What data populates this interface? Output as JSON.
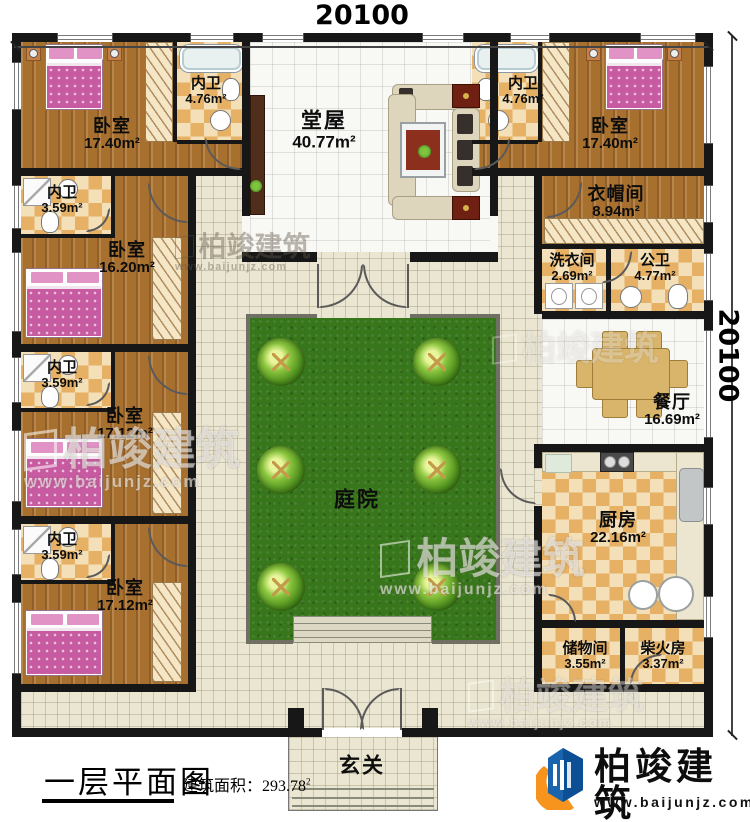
{
  "dimensions": {
    "top": "20100",
    "right": "20100"
  },
  "title_block": {
    "title": "一层平面图",
    "area_label": "建筑面积：",
    "area_value": "293.78",
    "area_sup": "2"
  },
  "brand": {
    "name": "柏竣建筑",
    "url": "www.baijunjz.com"
  },
  "watermark": {
    "name": "柏竣建筑",
    "url": "www.baijunjz.com"
  },
  "rooms": {
    "bedroom_nw": {
      "name": "卧室",
      "area": "17.40m²"
    },
    "ensuite_nw": {
      "name": "内卫",
      "area": "4.76m²"
    },
    "hall": {
      "name": "堂屋",
      "area": "40.77m²"
    },
    "ensuite_ne": {
      "name": "内卫",
      "area": "4.76m²"
    },
    "bedroom_ne": {
      "name": "卧室",
      "area": "17.40m²"
    },
    "bath_w1": {
      "name": "内卫",
      "area": "3.59m²"
    },
    "bedroom_w2": {
      "name": "卧室",
      "area": "16.20m²"
    },
    "cloakroom": {
      "name": "衣帽间",
      "area": "8.94m²"
    },
    "laundry": {
      "name": "洗衣间",
      "area": "2.69m²"
    },
    "public_bath": {
      "name": "公卫",
      "area": "4.77m²"
    },
    "bath_w2": {
      "name": "内卫",
      "area": "3.59m²"
    },
    "bedroom_w3": {
      "name": "卧室",
      "area": "17.12m²"
    },
    "dining": {
      "name": "餐厅",
      "area": "16.69m²"
    },
    "courtyard": {
      "name": "庭院"
    },
    "bath_w3": {
      "name": "内卫",
      "area": "3.59m²"
    },
    "bedroom_w4": {
      "name": "卧室",
      "area": "17.12m²"
    },
    "kitchen": {
      "name": "厨房",
      "area": "22.16m²"
    },
    "storage": {
      "name": "储物间",
      "area": "3.55m²"
    },
    "firewood": {
      "name": "柴火房",
      "area": "3.37m²"
    },
    "foyer": {
      "name": "玄关"
    }
  }
}
